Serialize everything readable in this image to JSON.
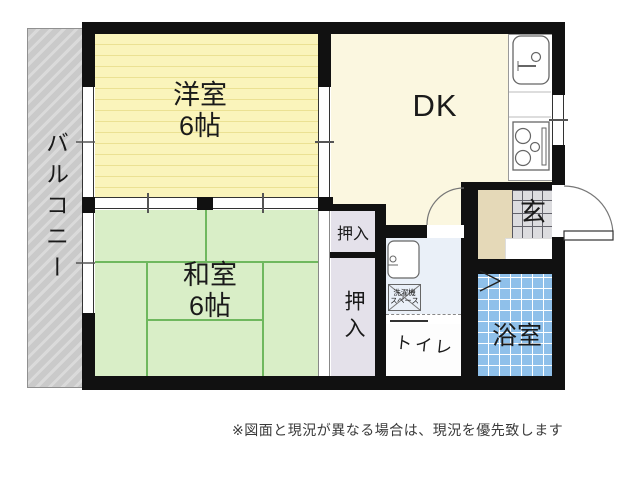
{
  "rooms": {
    "balcony": {
      "label": "バルコニー"
    },
    "western_room": {
      "label": "洋室",
      "size": "6帖"
    },
    "japanese_room": {
      "label": "和室",
      "size": "6帖"
    },
    "dining_kitchen": {
      "label": "DK"
    },
    "closet_upper": {
      "label": "押入"
    },
    "closet_lower": {
      "label": "押入"
    },
    "toilet": {
      "label": "トイレ"
    },
    "bathroom": {
      "label": "浴室"
    },
    "entrance": {
      "label": "玄"
    },
    "washer_space": {
      "line1": "洗濯機",
      "line2": "スペース"
    }
  },
  "note": "※図面と現況が異なる場合は、現況を優先致します",
  "icons": {
    "kitchen_sink": "kitchen-sink-icon",
    "stove": "stove-icon",
    "washbasin": "washbasin-icon",
    "entry_door": "door-swing-arc-icon",
    "dk_door": "door-swing-arc-icon",
    "bath_door": "folding-door-chevron-icon"
  },
  "colors": {
    "wall": "#111111",
    "western_room": "#faf4bb",
    "western_room_stripe": "#ebe193",
    "japanese_room": "#d9eec7",
    "tatami_line": "#6fb85e",
    "dk": "#fbf7e0",
    "closet": "#e4e1ea",
    "washroom": "#eaf0f8",
    "bathroom": "#8fc0ea",
    "bathroom_grid": "#ffffff",
    "entrance_tile": "#dcdcdf",
    "entrance_tile_line": "#63636b",
    "hall": "#e5d9b8",
    "balcony": "#cacaca",
    "balcony_stripe": "#dadada",
    "text": "#1a1a1a"
  }
}
